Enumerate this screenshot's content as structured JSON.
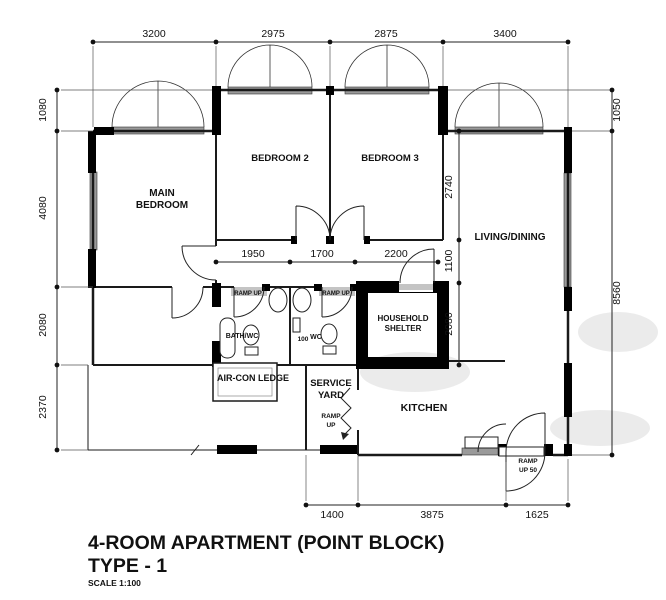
{
  "plan": {
    "title_line1": "4-ROOM APARTMENT (POINT BLOCK)",
    "title_line2": "TYPE - 1",
    "scale_note": "SCALE 1:100"
  },
  "rooms": {
    "main_bedroom_line1": "MAIN",
    "main_bedroom_line2": "BEDROOM",
    "bedroom2": "BEDROOM 2",
    "bedroom3": "BEDROOM 3",
    "living_dining": "LIVING/DINING",
    "household_shelter_line1": "HOUSEHOLD",
    "household_shelter_line2": "SHELTER",
    "aircon_ledge": "AIR-CON LEDGE",
    "service_yard_line1": "SERVICE",
    "service_yard_line2": "YARD",
    "kitchen": "KITCHEN",
    "bath1": "BATH/WC",
    "bath2": "WC"
  },
  "annotations": {
    "ramp_bath1": "RAMP UP",
    "ramp_bath2": "RAMP UP",
    "ramp_service_line1": "RAMP",
    "ramp_service_line2": "UP",
    "ramp_entrance_line1": "RAMP",
    "ramp_entrance_line2": "UP 50",
    "step_height": "100"
  },
  "dimensions": {
    "top": [
      "3200",
      "2975",
      "2875",
      "3400"
    ],
    "left": [
      "1080",
      "4080",
      "2080",
      "2370"
    ],
    "right": [
      "1050",
      "8560"
    ],
    "bottom": [
      "1400",
      "3875",
      "1625"
    ],
    "corridor": [
      "1950",
      "1700",
      "2200"
    ],
    "vertical_inner": [
      "2740",
      "1100",
      "2080"
    ]
  },
  "colors": {
    "ink": "#1a1a1a",
    "wall": "#000000",
    "window": "#9a9a9a",
    "threshold": "#bdbdbd",
    "watermark": "#d8d8d8"
  }
}
